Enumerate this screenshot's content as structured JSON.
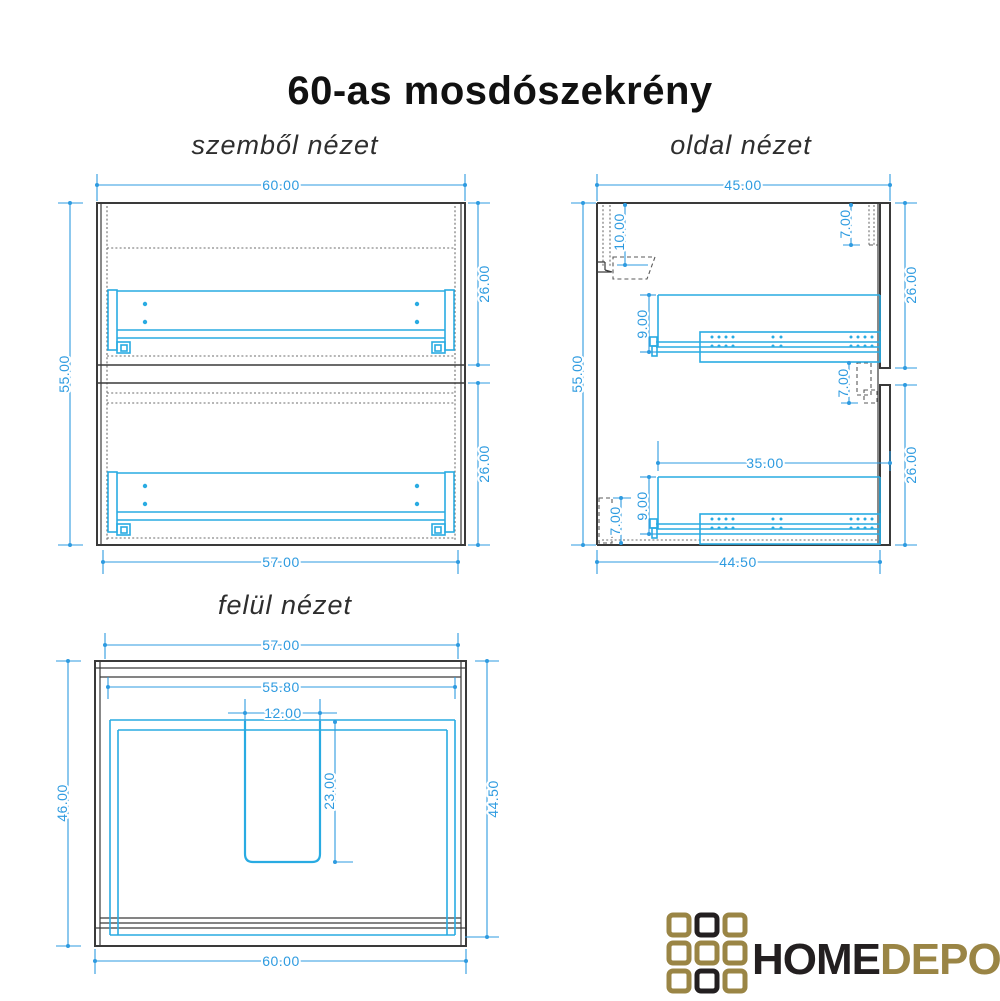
{
  "title": "60-as mosdószekrény",
  "views": {
    "front": {
      "label": "szemből nézet",
      "dims": {
        "width_top": "60.00",
        "height_left": "55.00",
        "section_upper": "26.00",
        "section_lower": "26.00",
        "width_bottom": "57.00"
      }
    },
    "side": {
      "label": "oldal nézet",
      "dims": {
        "depth_top": "45.00",
        "height_left": "55.00",
        "hang_rail_offset": "10.00",
        "top_back_inset": "7.00",
        "section_upper": "26.00",
        "slide_upper_height": "9.00",
        "front_gap": "7.00",
        "slide_length": "35.00",
        "bottom_back_inset": "7.00",
        "section_lower": "26.00",
        "depth_bottom": "44.50"
      }
    },
    "top": {
      "label": "felül nézet",
      "dims": {
        "width_top": "57.00",
        "width_inner": "55.80",
        "cutout_width": "12.00",
        "cutout_depth": "23.00",
        "depth_left": "46.00",
        "depth_right": "44.50",
        "width_bottom": "60.00"
      }
    }
  },
  "logo": {
    "text_primary": "HOME",
    "text_secondary": "DEPO",
    "colors": {
      "gold": "#9A8545",
      "black": "#231F20"
    },
    "grid": [
      [
        "gold",
        "black",
        "gold"
      ],
      [
        "gold",
        "gold",
        "gold"
      ],
      [
        "gold",
        "black",
        "gold"
      ]
    ]
  },
  "colors": {
    "hardware": "#29ABE2",
    "dimension": "#2E9BE0",
    "line": "#3A3A3A"
  }
}
